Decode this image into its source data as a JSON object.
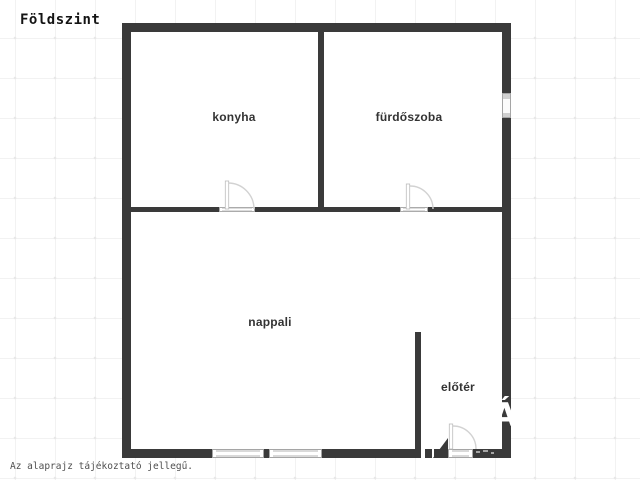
{
  "header": {
    "title": "Földszint"
  },
  "floorplan": {
    "rooms": [
      {
        "label": "konyha"
      },
      {
        "label": "fürdőszoba"
      },
      {
        "label": "nappali"
      },
      {
        "label": "előtér"
      }
    ],
    "watermark_glyph": "Á",
    "colors": {
      "wall": "#3a3a3a",
      "sill_fill": "#d9d9d9",
      "sill_border": "#a5a5a5",
      "door_arc": "#d2d2d2",
      "label_text": "#333333",
      "grid_line": "#f2f2f2",
      "background": "#ffffff"
    }
  },
  "footer": {
    "note": "Az alaprajz tájékoztató jellegű."
  }
}
